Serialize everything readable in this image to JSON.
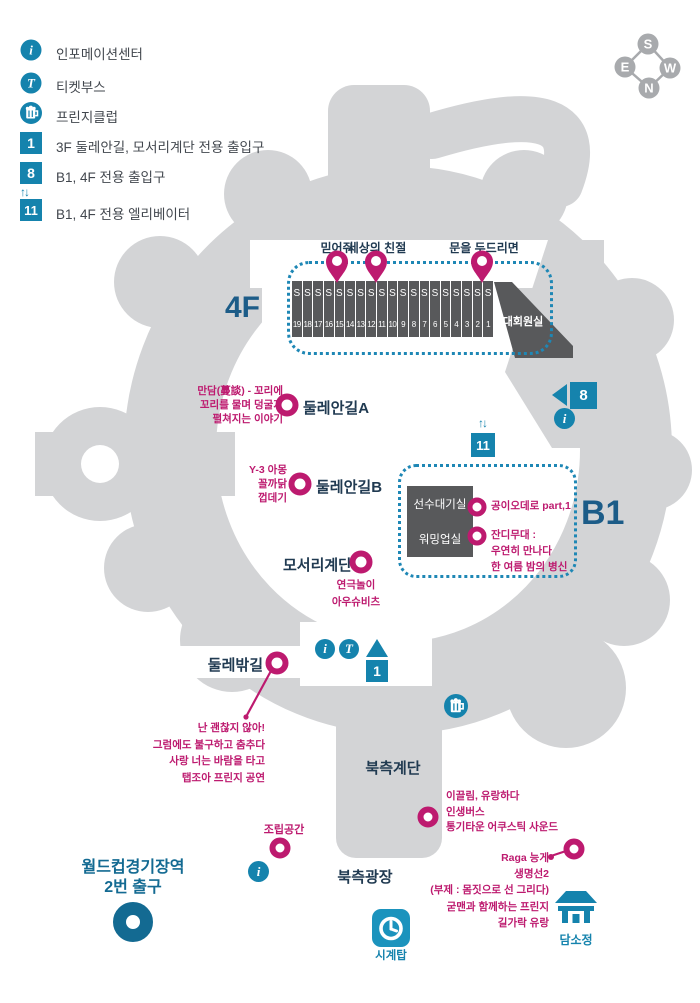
{
  "legend": {
    "items": [
      {
        "icon": "info-icon",
        "label": "인포메이션센터"
      },
      {
        "icon": "ticket-icon",
        "label": "티켓부스"
      },
      {
        "icon": "beer-icon",
        "label": "프린지클럽"
      },
      {
        "icon": "gate-1-icon",
        "label": "3F 둘레안길, 모서리계단 전용 출입구"
      },
      {
        "icon": "gate-8-icon",
        "label": "B1, 4F 전용 출입구"
      },
      {
        "icon": "elevator-icon",
        "label": "B1, 4F  전용 엘리베이터"
      }
    ]
  },
  "badges": {
    "one": "1",
    "eight": "8",
    "eleven": "11",
    "i": "i",
    "t": "T",
    "updown": "↑↓"
  },
  "compass": {
    "top": "S",
    "left": "E",
    "right": "W",
    "bottom": "N"
  },
  "floor_4f": {
    "label": "4F",
    "room": "대회원실",
    "stall_prefix": "S",
    "stall_numbers": [
      19,
      18,
      17,
      16,
      15,
      14,
      13,
      12,
      11,
      10,
      9,
      8,
      7,
      6,
      5,
      4,
      3,
      2,
      1
    ],
    "pins": [
      {
        "label": "믿어줘"
      },
      {
        "label": "세상의 친절"
      },
      {
        "label": "문을 두드리면"
      }
    ]
  },
  "floor_b1": {
    "label": "B1",
    "rooms": [
      "선수대기실",
      "워밍업실"
    ],
    "programs": [
      {
        "lines": [
          "공이오데로 part,1"
        ]
      },
      {
        "lines": [
          "잔디무대 :",
          "우연히 만나다",
          "한 여름 밤의 병신"
        ]
      }
    ]
  },
  "markers": {
    "dulle_a": {
      "name": "둘레안길A",
      "lines": [
        "만담(蔓談) - 꼬리에",
        "꼬리를 물며 덩굴져",
        "펼쳐지는 이야기"
      ]
    },
    "dulle_b": {
      "name": "둘레안길B",
      "lines": [
        "Y-3 아몽",
        "꼴까닭",
        "껍데기"
      ]
    },
    "moseori": {
      "name": "모서리계단",
      "lines": [
        "연극놀이",
        "아우슈비츠"
      ]
    },
    "dullebak": {
      "name": "둘레밖길",
      "lines": [
        "난 괜찮지 않아!",
        "그럼에도 불구하고 춤추다",
        "사랑 너는 바람을 타고",
        "탭조아 프린지 공연"
      ]
    },
    "ikkeullim": {
      "lines": [
        "이끌림, 유랑하다",
        "인생버스",
        "통기타운 어쿠스틱 사운드"
      ]
    },
    "jorip": {
      "name": "조립공간"
    },
    "raga": {
      "lines": [
        "Raga 능게",
        "생명선2",
        "(부제 : 몸짓으로 선 그리다)",
        "굳맨과 함께하는 프린지",
        "길가락 유랑"
      ]
    }
  },
  "places": {
    "north_stairs": "북측계단",
    "north_plaza": "북측광장",
    "clock_tower": "시계탑",
    "damsojeong": "담소정",
    "station": {
      "lines": [
        "월드컵경기장역",
        "2번 출구"
      ]
    }
  },
  "colors": {
    "blue": "#1583ad",
    "dotted_blue": "#1e87b5",
    "magenta": "#bd1a6f",
    "navy": "#203a51",
    "gray": "#d3d4d6",
    "dark_gray": "#58595b",
    "floor_blue": "#1c5c88",
    "station_blue": "#136a92"
  }
}
